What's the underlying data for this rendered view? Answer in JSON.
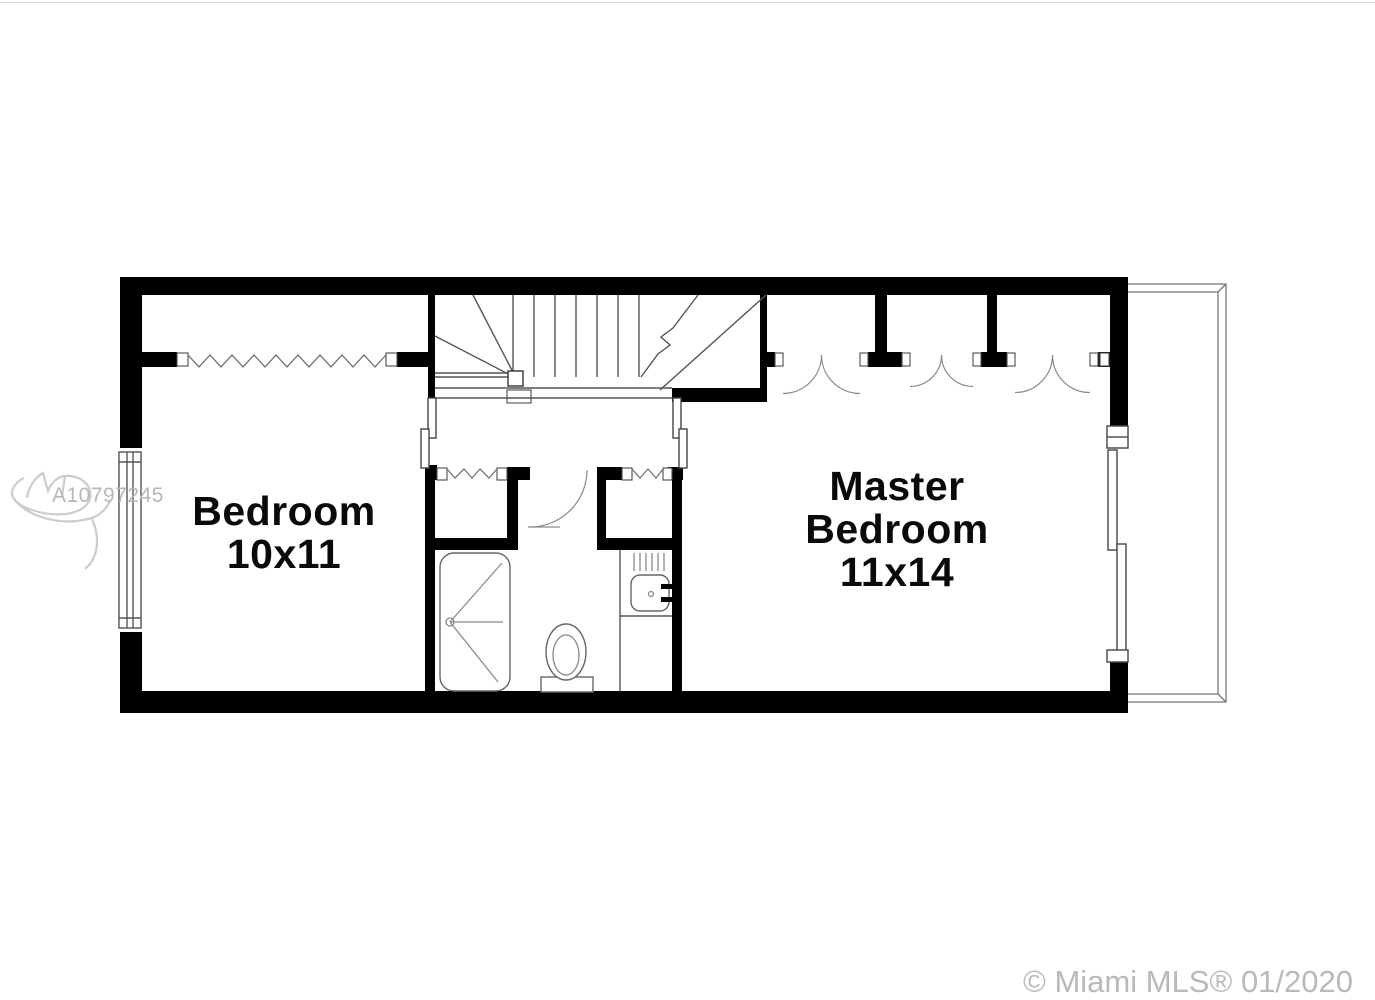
{
  "watermark": {
    "listing_id": "A10797245"
  },
  "footer": {
    "copyright": "© Miami MLS® 01/2020"
  },
  "floor_plan": {
    "rooms": [
      {
        "name": "Bedroom",
        "dimensions": "10x11",
        "label_lines": [
          "Bedroom",
          "10x11"
        ]
      },
      {
        "name": "Master Bedroom",
        "dimensions": "11x14",
        "label_lines": [
          "Master",
          "Bedroom",
          "11x14"
        ]
      }
    ],
    "fixtures": [
      "stairs",
      "shower",
      "toilet",
      "vanity-sink",
      "accordion-closet-doors",
      "double-door-closets",
      "sliding-glass-door",
      "window",
      "balcony"
    ],
    "colors": {
      "walls": "#000000",
      "labels": "#0a0a0a",
      "watermark": "#b7b7b7",
      "copyright_text": "#b9b9b9"
    }
  }
}
